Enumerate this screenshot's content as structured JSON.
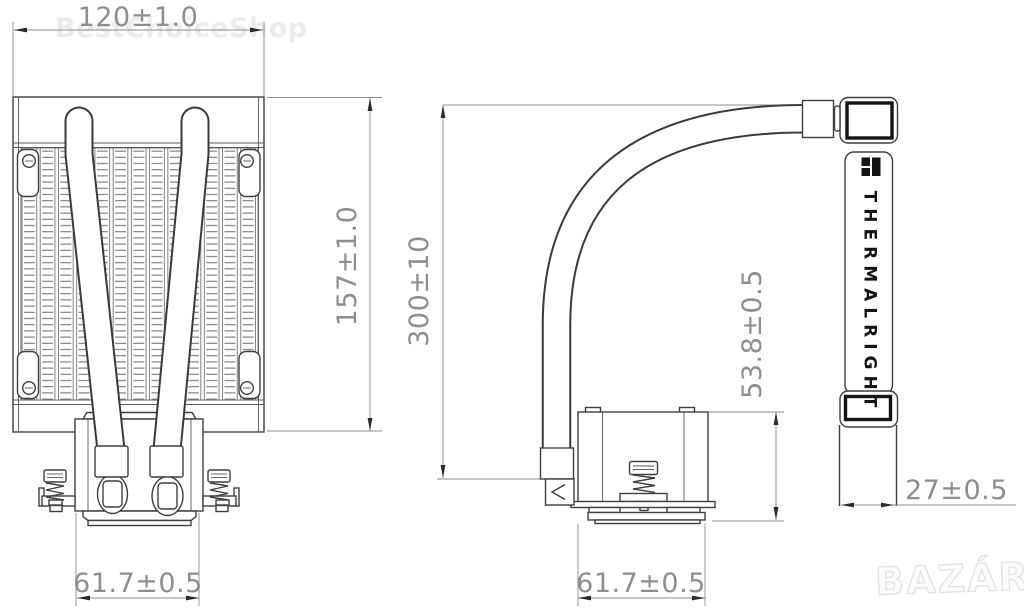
{
  "watermarks": {
    "top_left": "BestChoiceShop",
    "bottom_right": "BAZÁR"
  },
  "brand": {
    "logo_text": "THERMALRIGHT"
  },
  "drawing": {
    "type": "technical-dimension-diagram",
    "subject": "AIO liquid CPU cooler (120mm radiator, pump block, tubes)",
    "views": [
      "front-view",
      "side-view"
    ]
  },
  "dimensions": {
    "radiator_width": "120±1.0",
    "radiator_height": "157±1.0",
    "tube_length": "300±10",
    "pump_height": "53.8±0.5",
    "pump_width_front": "61.7±0.5",
    "pump_width_side": "61.7±0.5",
    "radiator_thickness": "27±0.5"
  },
  "colors": {
    "background": "#ffffff",
    "drawing_line": "#3f3f3f",
    "dimension_line": "#8c8c8c",
    "dimension_text": "#8e8e8e",
    "brand_black": "#141414",
    "watermark_gray": "#ececec"
  }
}
